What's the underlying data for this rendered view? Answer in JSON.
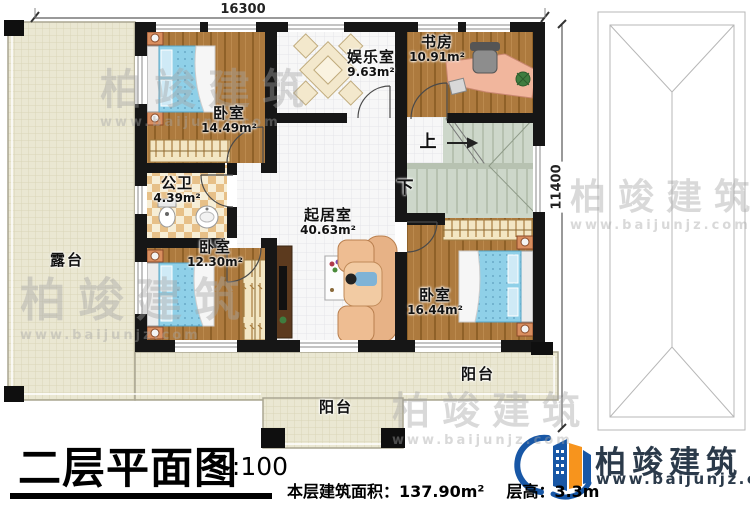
{
  "plan": {
    "dimensions": {
      "width_mm": "16300",
      "height_mm": "11400"
    },
    "rooms": {
      "bedroom_top": {
        "name": "卧室",
        "area": "14.49m²"
      },
      "bathroom": {
        "name": "公卫",
        "area": "4.39m²"
      },
      "bedroom_left": {
        "name": "卧室",
        "area": "12.30m²"
      },
      "entertainment": {
        "name": "娱乐室",
        "area": "9.63m²"
      },
      "study": {
        "name": "书房",
        "area": "10.91m²"
      },
      "living": {
        "name": "起居室",
        "area": "40.63m²"
      },
      "bedroom_right": {
        "name": "卧室",
        "area": "16.44m²"
      },
      "terrace": {
        "name": "露台"
      },
      "balcony_bottom": {
        "name": "阳台"
      },
      "balcony_right": {
        "name": "阳台"
      }
    },
    "stairs": {
      "up": "上",
      "down": "下"
    }
  },
  "titleblock": {
    "title": "二层平面图",
    "scale": "1:100",
    "area_label": "本层建筑面积：",
    "area_value": "137.90m²",
    "floor_height_label": "层高：",
    "floor_height_value": "3.3m"
  },
  "brand": {
    "name": "柏竣建筑",
    "website": "www.baijunjz.com"
  },
  "watermark": {
    "name": "柏竣建筑",
    "website": "www.baijunjz.com"
  },
  "colors": {
    "wall": "#161616",
    "wood_floor": "#ad7a3e",
    "outdoor_tile": "#eae7d2",
    "indoor_tile": "#f7f7f7",
    "stairs": "#cdd7ca",
    "bed": "#8fd0e8",
    "brand_blue": "#1857a6",
    "brand_orange": "#f7941d"
  }
}
